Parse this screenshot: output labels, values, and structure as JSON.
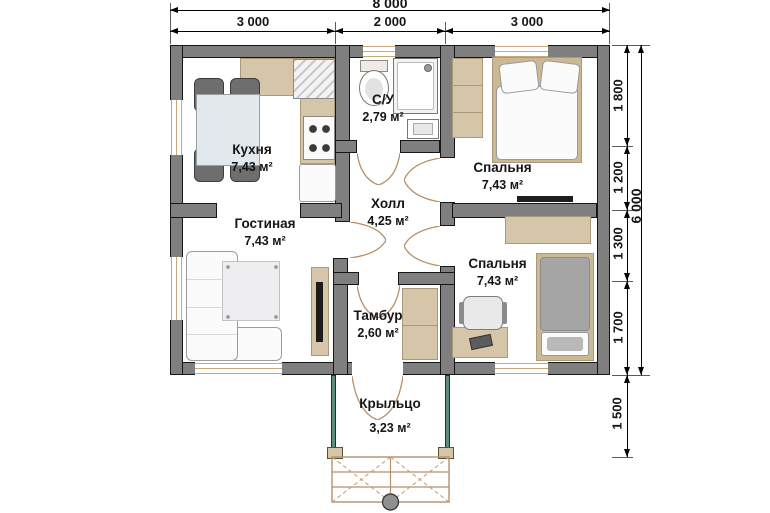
{
  "title": "floor-plan",
  "rooms": [
    {
      "id": "kitchen",
      "name": "Кухня",
      "area": "7,43 м²"
    },
    {
      "id": "living",
      "name": "Гостиная",
      "area": "7,43 м²"
    },
    {
      "id": "bathroom",
      "name": "С/У",
      "area": "2,79 м²"
    },
    {
      "id": "hall",
      "name": "Холл",
      "area": "4,25 м²"
    },
    {
      "id": "bedroom1",
      "name": "Спальня",
      "area": "7,43 м²"
    },
    {
      "id": "bedroom2",
      "name": "Спальня",
      "area": "7,43 м²"
    },
    {
      "id": "vestibule",
      "name": "Тамбур",
      "area": "2,60 м²"
    },
    {
      "id": "porch",
      "name": "Крыльцо",
      "area": "3,23 м²"
    }
  ],
  "dimensions": {
    "top": {
      "total": "8 000",
      "segments": [
        "3 000",
        "2 000",
        "3 000"
      ]
    },
    "right": {
      "total": "6 000",
      "segments": [
        "1 800",
        "1 200",
        "1 300",
        "1 700"
      ],
      "porch": "1 500"
    }
  },
  "colors": {
    "wall": "#7f7f7f",
    "wood": "#d5c6aa",
    "window_frame": "#c9a87c",
    "door_arc": "#b5906b",
    "porch_post": "#5d8d80"
  }
}
